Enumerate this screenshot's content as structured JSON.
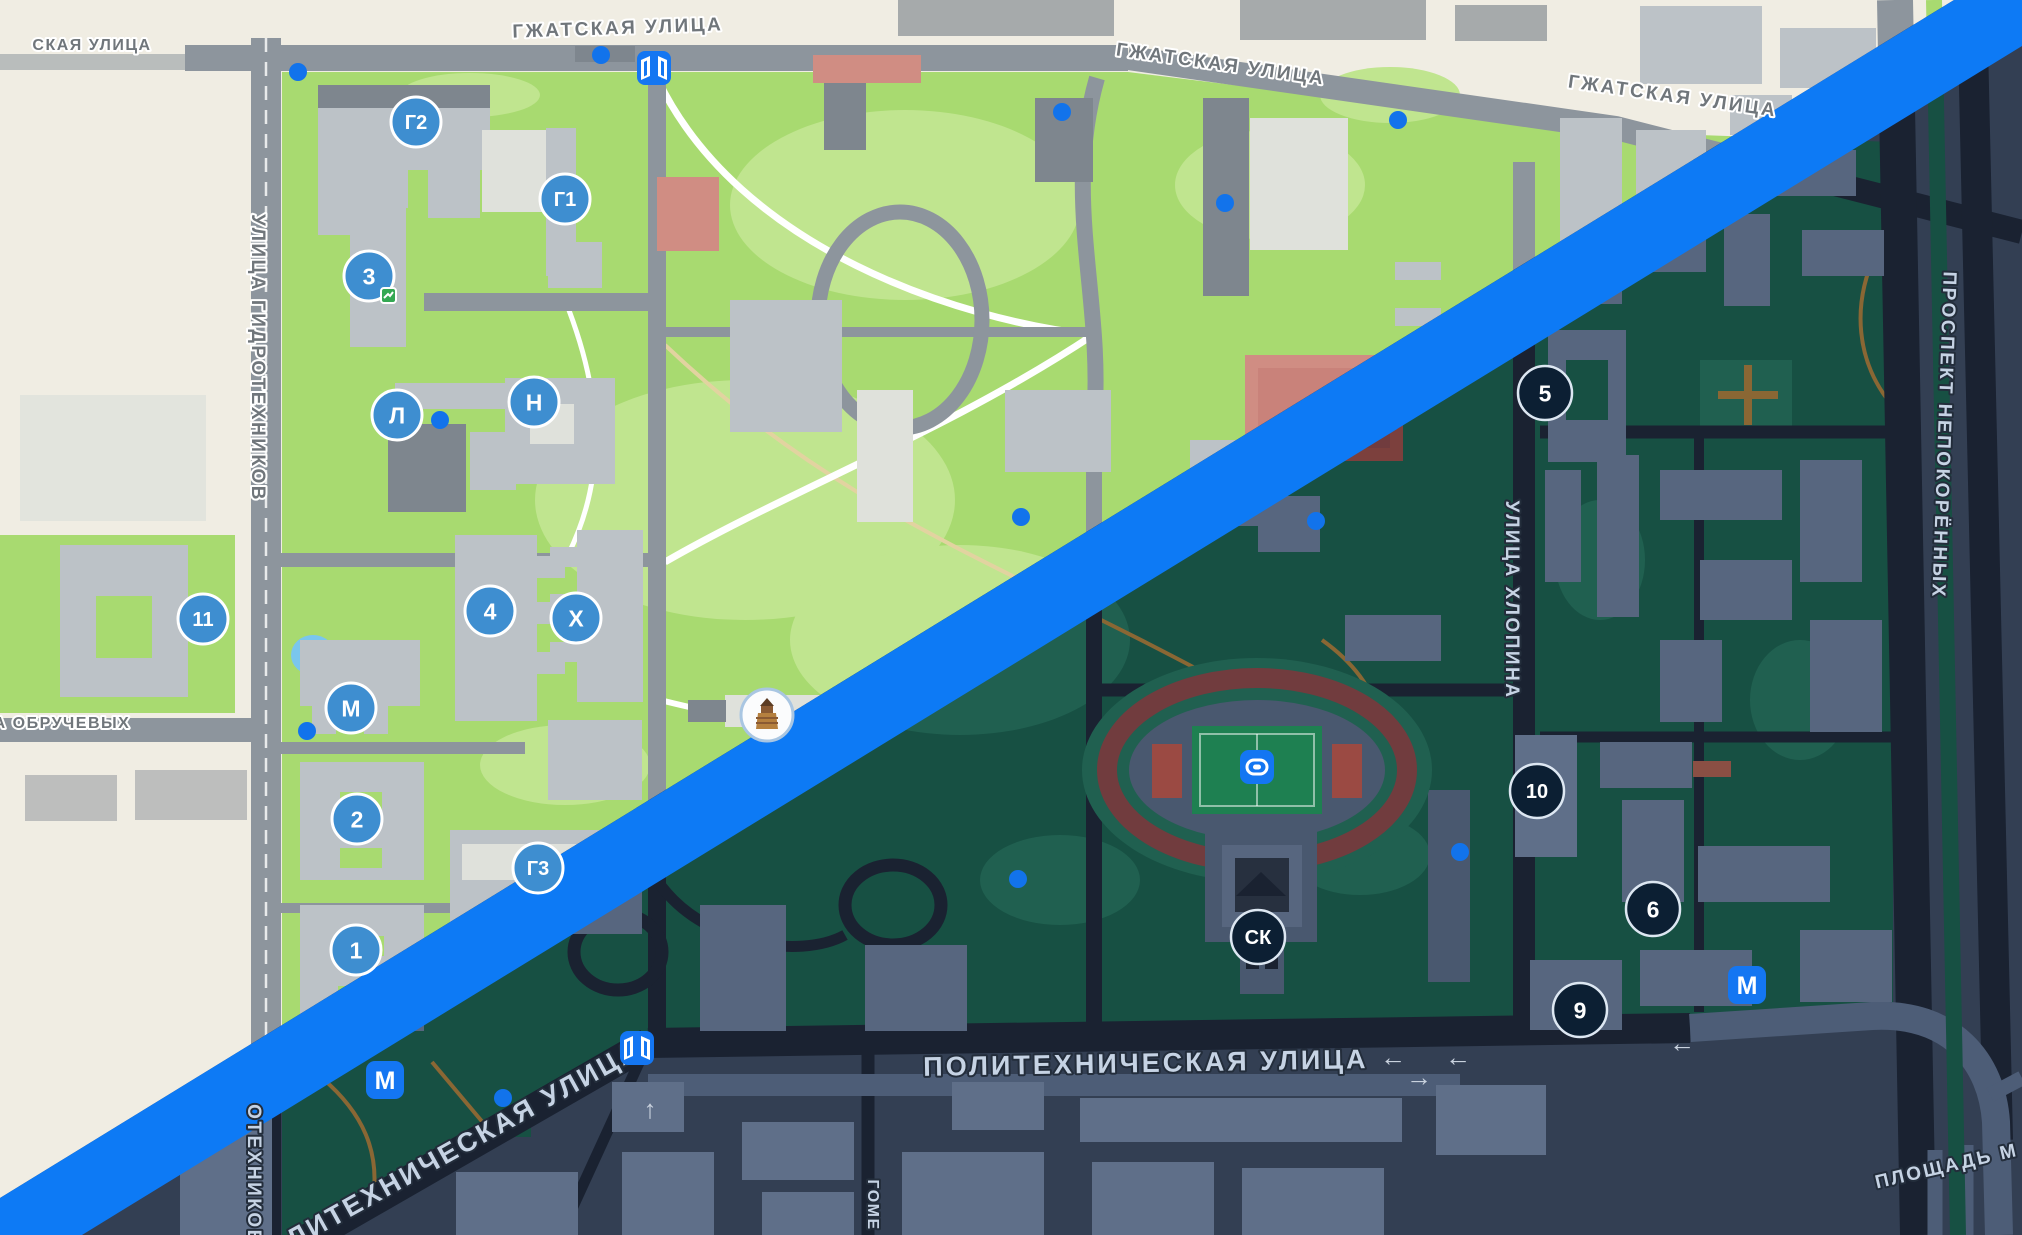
{
  "app": {
    "name": "Карта кампуса",
    "description": "Map screenshot split diagonally into light and dark themes"
  },
  "divider": {
    "color": "#0d7af5"
  },
  "themes": {
    "light": {
      "land": "#f0ede3",
      "park": "#a8da70",
      "park_light": "#c0e58f",
      "building": "#bcc2c7",
      "building_light": "#dfe1db",
      "building_dark": "#7e868e",
      "road": "#8d959d",
      "road_light": "#b6bcc2",
      "path": "#ffffff",
      "path_dirt": "#e2d3a0",
      "court": "#d08d83",
      "water": "#7ac6ee",
      "label": "#70767b",
      "marker_fill": "#3e8ed0"
    },
    "dark": {
      "land": "#333f53",
      "park": "#175043",
      "park_light": "#206050",
      "building": "#57667f",
      "building_light": "#5f6f89",
      "building_dark": "#49586f",
      "road": "#1a2231",
      "road_light": "#4d5d77",
      "path": "#2f3b4b",
      "path_dirt": "#8a6734",
      "court": "#7c403d",
      "water": "#1d4e66",
      "label": "#c6d3e4",
      "marker_fill": "#0c1f33"
    }
  },
  "street_labels": [
    {
      "text": "СКАЯ УЛИЦА",
      "x": 92,
      "y": 50,
      "rot": 0,
      "theme": "light",
      "cls": "sm"
    },
    {
      "text": "ГЖАТСКАЯ УЛИЦА",
      "x": 618,
      "y": 34,
      "rot": -2,
      "theme": "light",
      "cls": ""
    },
    {
      "text": "ГЖАТСКАЯ УЛИЦА",
      "x": 1220,
      "y": 70,
      "rot": 8,
      "theme": "light",
      "cls": ""
    },
    {
      "text": "ГЖАТСКАЯ УЛИЦА",
      "x": 1672,
      "y": 102,
      "rot": 8,
      "theme": "light",
      "cls": ""
    },
    {
      "text": "УЛИЦА ГИДРОТЕХНИКОВ",
      "x": 252,
      "y": 358,
      "rot": 90,
      "theme": "light",
      "cls": ""
    },
    {
      "text": "А ОБРУЧЕВЫХ",
      "x": 62,
      "y": 728,
      "rot": 0,
      "theme": "light",
      "cls": "sm"
    },
    {
      "text": "ПРОСПЕКТ НЕПОКОРЁННЫХ",
      "x": 1938,
      "y": 435,
      "rot": 92,
      "theme": "dark",
      "cls": ""
    },
    {
      "text": "УЛИЦА ХЛОПИНА",
      "x": 1506,
      "y": 600,
      "rot": 90,
      "theme": "dark",
      "cls": ""
    },
    {
      "text": "ПОЛИТЕХНИЧЕСКАЯ УЛИЦА",
      "x": 1146,
      "y": 1072,
      "rot": -1,
      "theme": "dark",
      "cls": "big"
    },
    {
      "text": "ПОЛИТЕХНИЧЕСКАЯ УЛИЦА",
      "x": 448,
      "y": 1163,
      "rot": -29,
      "theme": "dark",
      "cls": "big"
    },
    {
      "text": "ОТЕХНИКОВ",
      "x": 248,
      "y": 1175,
      "rot": 90,
      "theme": "dark",
      "cls": ""
    },
    {
      "text": "ПЛОЩАДЬ М",
      "x": 1948,
      "y": 1172,
      "rot": -13,
      "theme": "dark",
      "cls": ""
    },
    {
      "text": "ГОМЕ",
      "x": 868,
      "y": 1205,
      "rot": 90,
      "theme": "dark",
      "cls": "sm"
    }
  ],
  "markers": [
    {
      "label": "Г2",
      "x": 416,
      "y": 122,
      "theme": "light"
    },
    {
      "label": "Г1",
      "x": 565,
      "y": 199,
      "theme": "light"
    },
    {
      "label": "3",
      "x": 369,
      "y": 276,
      "theme": "light",
      "badge": true
    },
    {
      "label": "Л",
      "x": 397,
      "y": 415,
      "theme": "light"
    },
    {
      "label": "Н",
      "x": 534,
      "y": 402,
      "theme": "light"
    },
    {
      "label": "11",
      "x": 203,
      "y": 619,
      "theme": "light"
    },
    {
      "label": "4",
      "x": 490,
      "y": 611,
      "theme": "light"
    },
    {
      "label": "Х",
      "x": 576,
      "y": 618,
      "theme": "light"
    },
    {
      "label": "М",
      "x": 351,
      "y": 708,
      "theme": "light"
    },
    {
      "label": "2",
      "x": 357,
      "y": 819,
      "theme": "light"
    },
    {
      "label": "1",
      "x": 356,
      "y": 950,
      "theme": "light"
    },
    {
      "label": "Г3",
      "x": 538,
      "y": 868,
      "theme": "light"
    },
    {
      "label": "5",
      "x": 1545,
      "y": 393,
      "theme": "dark"
    },
    {
      "label": "10",
      "x": 1537,
      "y": 791,
      "theme": "dark"
    },
    {
      "label": "6",
      "x": 1653,
      "y": 909,
      "theme": "dark"
    },
    {
      "label": "9",
      "x": 1580,
      "y": 1010,
      "theme": "dark"
    },
    {
      "label": "СК",
      "x": 1258,
      "y": 937,
      "theme": "dark"
    }
  ],
  "icons": [
    {
      "type": "gate",
      "x": 654,
      "y": 68
    },
    {
      "type": "gate",
      "x": 637,
      "y": 1048
    },
    {
      "type": "metro",
      "x": 385,
      "y": 1080
    },
    {
      "type": "metro",
      "x": 1747,
      "y": 985
    },
    {
      "type": "stadium",
      "x": 1257,
      "y": 767
    },
    {
      "type": "monument",
      "x": 767,
      "y": 715
    }
  ],
  "dots": [
    [
      298,
      72
    ],
    [
      601,
      55
    ],
    [
      1062,
      112
    ],
    [
      1225,
      203
    ],
    [
      1398,
      120
    ],
    [
      440,
      420
    ],
    [
      1021,
      517
    ],
    [
      307,
      731
    ],
    [
      1316,
      521
    ],
    [
      1460,
      852
    ],
    [
      503,
      1098
    ],
    [
      1018,
      879
    ]
  ],
  "arrows": [
    {
      "glyph": "←",
      "x": 1393,
      "y": 1066
    },
    {
      "glyph": "→",
      "x": 1419,
      "y": 1086
    },
    {
      "glyph": "←",
      "x": 1682,
      "y": 1052
    },
    {
      "glyph": "←",
      "x": 1458,
      "y": 1066
    },
    {
      "glyph": "↑",
      "x": 650,
      "y": 1118
    }
  ]
}
